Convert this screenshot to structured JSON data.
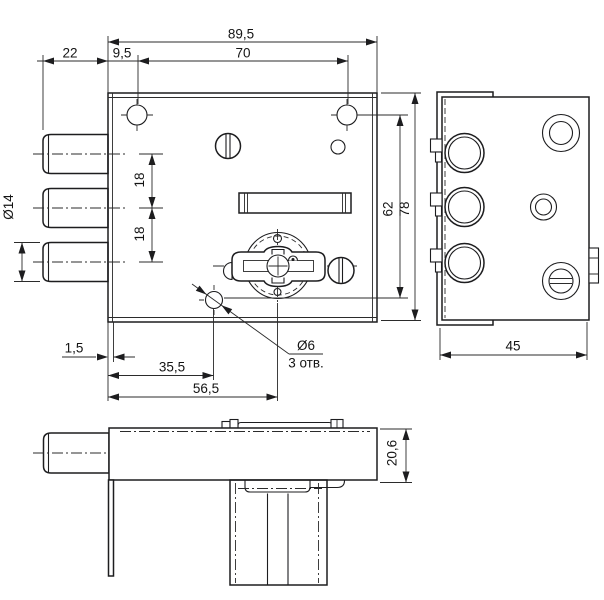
{
  "meta": {
    "type": "technical-drawing",
    "subject": "door lock mechanism with three deadbolts, cylinder and three orthographic views",
    "background": "#ffffff",
    "line_color": "#1d1d1f"
  },
  "views": {
    "front": "front-view",
    "side": "side-view",
    "bottom": "bottom-view"
  },
  "dims": {
    "overall_width": "89,5",
    "bolt_protrusion": "22",
    "edge_to_hole": "9,5",
    "hole_spacing": "70",
    "bolt_diameter": "Ø14",
    "bolt_pitch_1": "18",
    "bolt_pitch_2": "18",
    "vertical_span": "62",
    "overall_height": "78",
    "faceplate_offset": "1,5",
    "hole_offset": "35,5",
    "cylinder_offset": "56,5",
    "drill_diameter": "Ø6",
    "drill_count": "3 отв.",
    "depth": "45",
    "thickness": "20,6"
  }
}
